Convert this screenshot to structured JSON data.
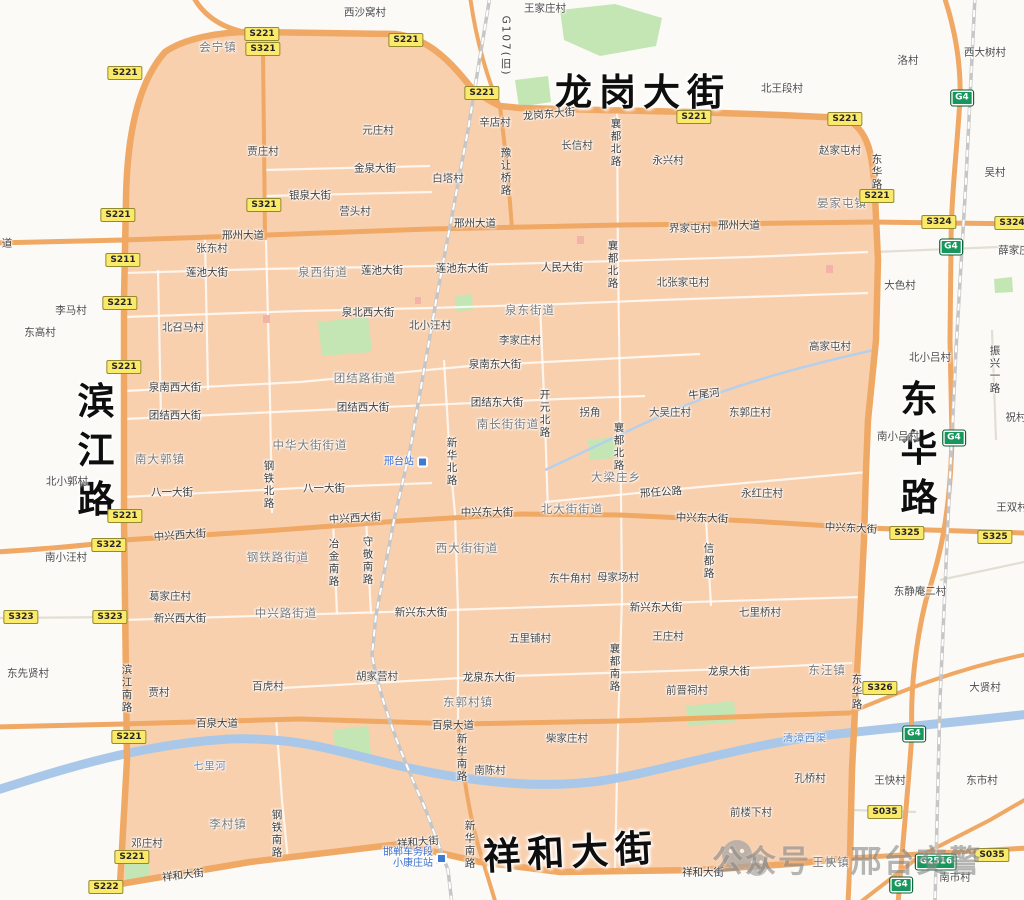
{
  "colors": {
    "zone_fill": "#f8d0ae",
    "road_orange": "#f0a865",
    "water": "#a9c8e9",
    "green": "#c3e6b4",
    "shield_yellow": "#fbe96a",
    "shield_green": "#17975c",
    "big_label": "#0e0e0e",
    "station_blue": "#3f79d8"
  },
  "map": {
    "big_labels": [
      {
        "t": "龙岗大街",
        "x": 643,
        "y": 89,
        "v": 0
      },
      {
        "t": "滨江路",
        "x": 92,
        "y": 455,
        "v": 1
      },
      {
        "t": "东华路",
        "x": 915,
        "y": 453,
        "v": 1
      },
      {
        "t": "祥和大街",
        "x": 571,
        "y": 849,
        "v": 0,
        "r": -3
      }
    ],
    "towns": [
      {
        "t": "会宁镇",
        "x": 218,
        "y": 47
      },
      {
        "t": "晏家屯镇",
        "x": 842,
        "y": 203
      },
      {
        "t": "南大郭镇",
        "x": 160,
        "y": 459
      },
      {
        "t": "大梁庄乡",
        "x": 616,
        "y": 477
      },
      {
        "t": "李村镇",
        "x": 228,
        "y": 824
      },
      {
        "t": "东郭村镇",
        "x": 468,
        "y": 702
      },
      {
        "t": "东汪镇",
        "x": 827,
        "y": 670
      },
      {
        "t": "王快镇",
        "x": 831,
        "y": 862
      },
      {
        "t": "泉西街道",
        "x": 323,
        "y": 272
      },
      {
        "t": "泉东街道",
        "x": 530,
        "y": 310
      },
      {
        "t": "团结路街道",
        "x": 365,
        "y": 378
      },
      {
        "t": "中华大街街道",
        "x": 310,
        "y": 445
      },
      {
        "t": "南长街街道",
        "x": 508,
        "y": 424
      },
      {
        "t": "北大街街道",
        "x": 572,
        "y": 509
      },
      {
        "t": "西大街街道",
        "x": 467,
        "y": 548
      },
      {
        "t": "钢铁路街道",
        "x": 278,
        "y": 557
      },
      {
        "t": "中兴路街道",
        "x": 286,
        "y": 613
      }
    ],
    "villages": [
      {
        "t": "西沙窝村",
        "x": 365,
        "y": 12
      },
      {
        "t": "王家庄村",
        "x": 545,
        "y": 8
      },
      {
        "t": "元庄村",
        "x": 378,
        "y": 130
      },
      {
        "t": "贾庄村",
        "x": 263,
        "y": 151
      },
      {
        "t": "白塔村",
        "x": 448,
        "y": 178
      },
      {
        "t": "营头村",
        "x": 355,
        "y": 211
      },
      {
        "t": "辛店村",
        "x": 495,
        "y": 122
      },
      {
        "t": "北王段村",
        "x": 782,
        "y": 88
      },
      {
        "t": "长信村",
        "x": 577,
        "y": 145
      },
      {
        "t": "永兴村",
        "x": 668,
        "y": 160
      },
      {
        "t": "赵家屯村",
        "x": 840,
        "y": 150
      },
      {
        "t": "洛村",
        "x": 908,
        "y": 60
      },
      {
        "t": "西大树村",
        "x": 985,
        "y": 52
      },
      {
        "t": "吴村",
        "x": 995,
        "y": 172
      },
      {
        "t": "界家屯村",
        "x": 690,
        "y": 228
      },
      {
        "t": "张东村",
        "x": 212,
        "y": 248
      },
      {
        "t": "北张家屯村",
        "x": 683,
        "y": 282
      },
      {
        "t": "大色村",
        "x": 900,
        "y": 285
      },
      {
        "t": "李马村",
        "x": 71,
        "y": 310
      },
      {
        "t": "东高村",
        "x": 40,
        "y": 332
      },
      {
        "t": "北召马村",
        "x": 183,
        "y": 327
      },
      {
        "t": "北小汪村",
        "x": 430,
        "y": 325
      },
      {
        "t": "李家庄村",
        "x": 520,
        "y": 340
      },
      {
        "t": "高家屯村",
        "x": 830,
        "y": 346
      },
      {
        "t": "北小吕村",
        "x": 930,
        "y": 357
      },
      {
        "t": "南小吕村",
        "x": 898,
        "y": 436
      },
      {
        "t": "祝村",
        "x": 1016,
        "y": 417
      },
      {
        "t": "王双村",
        "x": 1012,
        "y": 507
      },
      {
        "t": "薛家庄",
        "x": 1014,
        "y": 250
      },
      {
        "t": "拐角",
        "x": 590,
        "y": 412
      },
      {
        "t": "大吴庄村",
        "x": 670,
        "y": 412
      },
      {
        "t": "东郭庄村",
        "x": 750,
        "y": 412
      },
      {
        "t": "永红庄村",
        "x": 762,
        "y": 493
      },
      {
        "t": "北小郭村",
        "x": 67,
        "y": 481
      },
      {
        "t": "南小汪村",
        "x": 66,
        "y": 557
      },
      {
        "t": "葛家庄村",
        "x": 170,
        "y": 596
      },
      {
        "t": "东先贤村",
        "x": 28,
        "y": 673
      },
      {
        "t": "贾村",
        "x": 159,
        "y": 692
      },
      {
        "t": "百虎村",
        "x": 268,
        "y": 686
      },
      {
        "t": "胡家营村",
        "x": 377,
        "y": 676
      },
      {
        "t": "东牛角村",
        "x": 570,
        "y": 578
      },
      {
        "t": "母家场村",
        "x": 618,
        "y": 577
      },
      {
        "t": "五里铺村",
        "x": 530,
        "y": 638
      },
      {
        "t": "王庄村",
        "x": 668,
        "y": 636
      },
      {
        "t": "七里桥村",
        "x": 760,
        "y": 612
      },
      {
        "t": "东静庵二村",
        "x": 920,
        "y": 591
      },
      {
        "t": "大贤村",
        "x": 985,
        "y": 687
      },
      {
        "t": "柴家庄村",
        "x": 567,
        "y": 738
      },
      {
        "t": "南陈村",
        "x": 490,
        "y": 770
      },
      {
        "t": "孔桥村",
        "x": 810,
        "y": 778
      },
      {
        "t": "王快村",
        "x": 890,
        "y": 780
      },
      {
        "t": "东市村",
        "x": 982,
        "y": 780
      },
      {
        "t": "前楼下村",
        "x": 751,
        "y": 812
      },
      {
        "t": "邓庄村",
        "x": 147,
        "y": 843
      },
      {
        "t": "南市村",
        "x": 955,
        "y": 877
      },
      {
        "t": "前晋祠村",
        "x": 687,
        "y": 690
      }
    ],
    "roads_h": [
      {
        "t": "邢州大道",
        "x": 243,
        "y": 235
      },
      {
        "t": "邢州大道",
        "x": 475,
        "y": 223
      },
      {
        "t": "邢州大道",
        "x": 739,
        "y": 225
      },
      {
        "t": "道",
        "x": 7,
        "y": 243
      },
      {
        "t": "龙岗东大街",
        "x": 549,
        "y": 114,
        "r": -5
      },
      {
        "t": "金泉大街",
        "x": 375,
        "y": 168
      },
      {
        "t": "银泉大街",
        "x": 310,
        "y": 195
      },
      {
        "t": "莲池大街",
        "x": 207,
        "y": 272
      },
      {
        "t": "莲池大街",
        "x": 382,
        "y": 270
      },
      {
        "t": "莲池东大街",
        "x": 462,
        "y": 268
      },
      {
        "t": "人民大街",
        "x": 562,
        "y": 267
      },
      {
        "t": "泉北西大街",
        "x": 368,
        "y": 312
      },
      {
        "t": "泉南西大街",
        "x": 175,
        "y": 387
      },
      {
        "t": "泉南东大街",
        "x": 495,
        "y": 364
      },
      {
        "t": "团结西大街",
        "x": 175,
        "y": 415
      },
      {
        "t": "团结西大街",
        "x": 363,
        "y": 407
      },
      {
        "t": "团结东大街",
        "x": 497,
        "y": 402
      },
      {
        "t": "八一大街",
        "x": 172,
        "y": 492
      },
      {
        "t": "八一大街",
        "x": 324,
        "y": 488
      },
      {
        "t": "中兴西大街",
        "x": 180,
        "y": 535,
        "r": -4
      },
      {
        "t": "中兴西大街",
        "x": 355,
        "y": 518,
        "r": -3
      },
      {
        "t": "中兴东大街",
        "x": 487,
        "y": 512
      },
      {
        "t": "中兴东大街",
        "x": 702,
        "y": 518,
        "r": 2
      },
      {
        "t": "中兴东大街",
        "x": 851,
        "y": 528,
        "r": 3
      },
      {
        "t": "新兴西大街",
        "x": 180,
        "y": 618
      },
      {
        "t": "新兴东大街",
        "x": 421,
        "y": 612
      },
      {
        "t": "新兴东大街",
        "x": 656,
        "y": 607
      },
      {
        "t": "百泉大道",
        "x": 217,
        "y": 723
      },
      {
        "t": "百泉大道",
        "x": 453,
        "y": 725
      },
      {
        "t": "龙泉东大街",
        "x": 489,
        "y": 677
      },
      {
        "t": "龙泉大街",
        "x": 729,
        "y": 671
      },
      {
        "t": "祥和大街",
        "x": 183,
        "y": 875,
        "r": -7
      },
      {
        "t": "祥和大街",
        "x": 418,
        "y": 842,
        "r": -5
      },
      {
        "t": "祥和大街",
        "x": 703,
        "y": 872
      },
      {
        "t": "邢任公路",
        "x": 661,
        "y": 492,
        "r": -4
      },
      {
        "t": "牛尾河",
        "x": 704,
        "y": 394,
        "r": -6
      }
    ],
    "roads_v": [
      {
        "t": "G107(旧)",
        "x": 506,
        "y": 46
      },
      {
        "t": "豫让桥路",
        "x": 506,
        "y": 172
      },
      {
        "t": "襄都北路",
        "x": 616,
        "y": 143
      },
      {
        "t": "襄都北路",
        "x": 613,
        "y": 265
      },
      {
        "t": "襄都北路",
        "x": 619,
        "y": 447
      },
      {
        "t": "襄都南路",
        "x": 615,
        "y": 668
      },
      {
        "t": "东华路",
        "x": 877,
        "y": 172
      },
      {
        "t": "东华路",
        "x": 857,
        "y": 692
      },
      {
        "t": "钢铁北路",
        "x": 269,
        "y": 485
      },
      {
        "t": "新华北路",
        "x": 452,
        "y": 462
      },
      {
        "t": "开元北路",
        "x": 545,
        "y": 414
      },
      {
        "t": "冶金南路",
        "x": 334,
        "y": 563
      },
      {
        "t": "守敬南路",
        "x": 368,
        "y": 561
      },
      {
        "t": "信都路",
        "x": 709,
        "y": 561
      },
      {
        "t": "滨江南路",
        "x": 127,
        "y": 689
      },
      {
        "t": "钢铁南路",
        "x": 277,
        "y": 834
      },
      {
        "t": "新华南路",
        "x": 462,
        "y": 758
      },
      {
        "t": "新华南路",
        "x": 470,
        "y": 845
      },
      {
        "t": "振兴一路",
        "x": 995,
        "y": 370
      }
    ],
    "rivers": [
      {
        "t": "七里河",
        "x": 210,
        "y": 765
      },
      {
        "t": "清漳西渠",
        "x": 805,
        "y": 737
      }
    ],
    "shields": [
      {
        "c": "S221",
        "x": 125,
        "y": 73
      },
      {
        "c": "S221",
        "x": 262,
        "y": 34
      },
      {
        "c": "S321",
        "x": 263,
        "y": 49
      },
      {
        "c": "S221",
        "x": 406,
        "y": 40
      },
      {
        "c": "S221",
        "x": 482,
        "y": 93
      },
      {
        "c": "S221",
        "x": 694,
        "y": 117
      },
      {
        "c": "S221",
        "x": 845,
        "y": 119
      },
      {
        "c": "S221",
        "x": 877,
        "y": 196
      },
      {
        "c": "S321",
        "x": 264,
        "y": 205
      },
      {
        "c": "S221",
        "x": 118,
        "y": 215
      },
      {
        "c": "S211",
        "x": 123,
        "y": 260
      },
      {
        "c": "S221",
        "x": 120,
        "y": 303
      },
      {
        "c": "S221",
        "x": 124,
        "y": 367
      },
      {
        "c": "S221",
        "x": 125,
        "y": 516
      },
      {
        "c": "S322",
        "x": 109,
        "y": 545
      },
      {
        "c": "S323",
        "x": 21,
        "y": 617
      },
      {
        "c": "S323",
        "x": 110,
        "y": 617
      },
      {
        "c": "S221",
        "x": 129,
        "y": 737
      },
      {
        "c": "S221",
        "x": 132,
        "y": 857
      },
      {
        "c": "S222",
        "x": 106,
        "y": 887
      },
      {
        "c": "S324",
        "x": 939,
        "y": 222
      },
      {
        "c": "S324",
        "x": 1012,
        "y": 223
      },
      {
        "c": "S325",
        "x": 907,
        "y": 533
      },
      {
        "c": "S325",
        "x": 995,
        "y": 537
      },
      {
        "c": "S326",
        "x": 880,
        "y": 688
      },
      {
        "c": "S035",
        "x": 885,
        "y": 812
      },
      {
        "c": "S035",
        "x": 992,
        "y": 855
      },
      {
        "c": "G4",
        "x": 962,
        "y": 98,
        "g": 1
      },
      {
        "c": "G4",
        "x": 951,
        "y": 247,
        "g": 1
      },
      {
        "c": "G4",
        "x": 954,
        "y": 438,
        "g": 1
      },
      {
        "c": "G4",
        "x": 914,
        "y": 734,
        "g": 1
      },
      {
        "c": "G4",
        "x": 901,
        "y": 885,
        "g": 1
      },
      {
        "c": "G2516",
        "x": 936,
        "y": 862,
        "g": 1
      }
    ],
    "stations": [
      {
        "lines": [
          "邢台站"
        ],
        "x": 406,
        "y": 462
      },
      {
        "lines": [
          "邯郸车务段",
          "小康庄站"
        ],
        "x": 415,
        "y": 858
      }
    ],
    "watermark": {
      "text": "公众号 · 邢台交警"
    }
  }
}
